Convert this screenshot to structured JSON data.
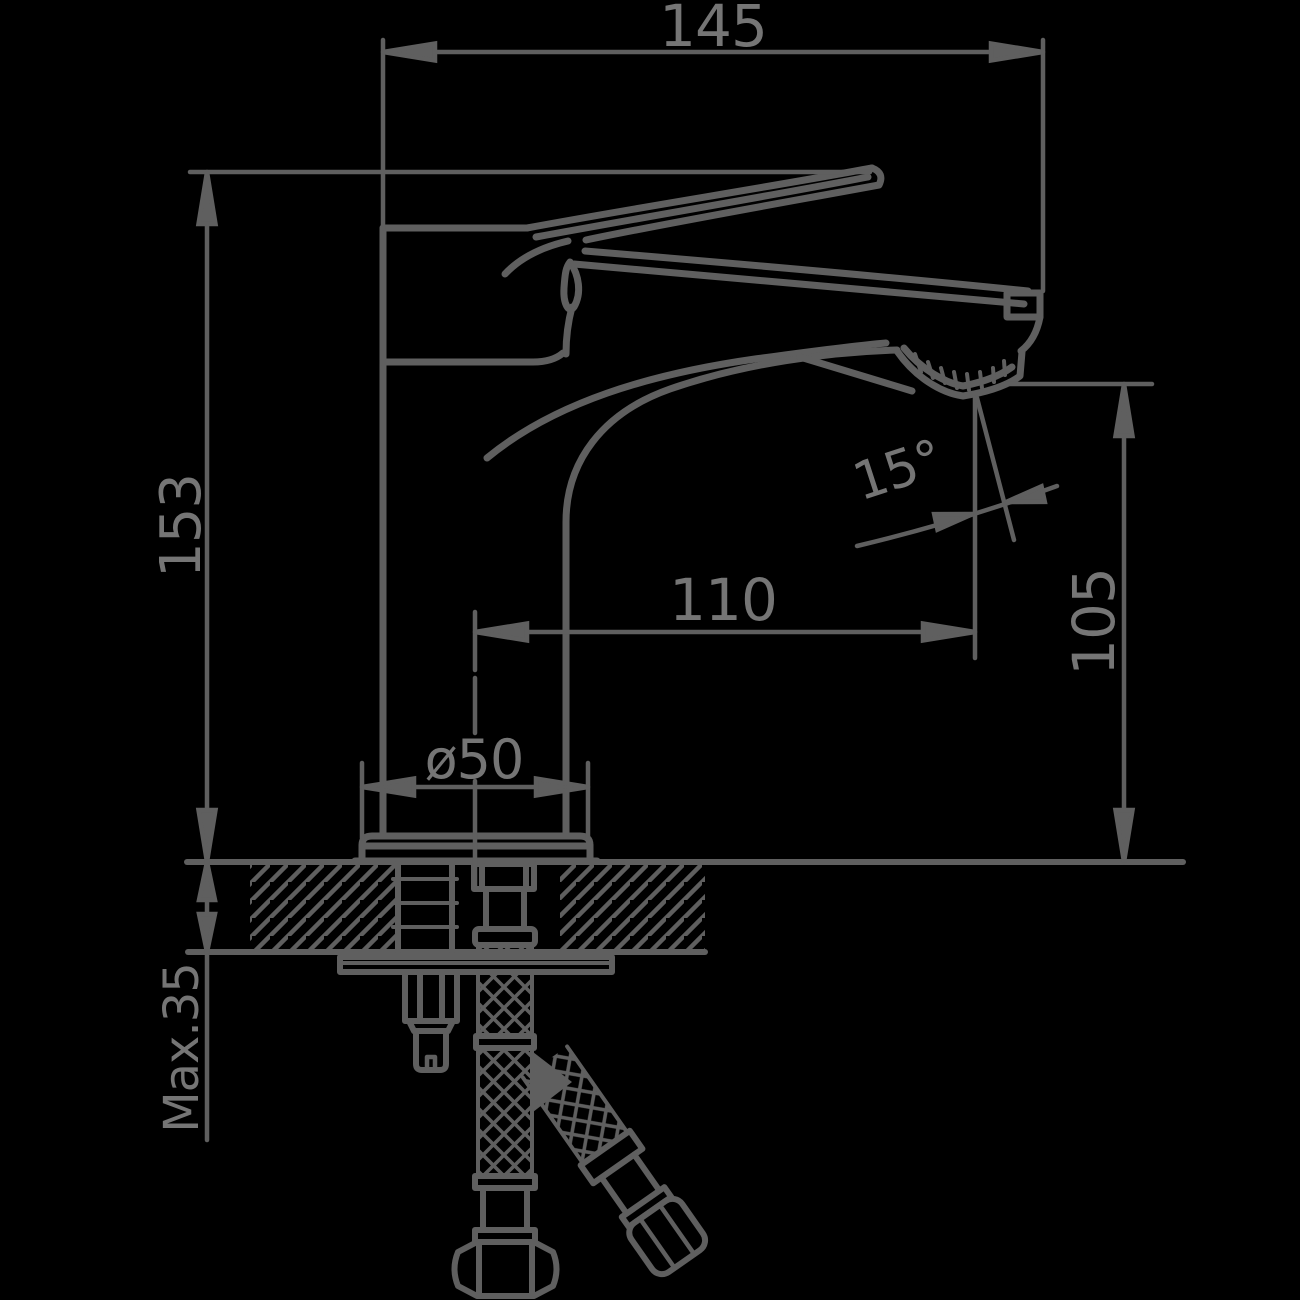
{
  "page": {
    "type": "technical dimension drawing",
    "subject": "single-lever basin mixer faucet, side elevation with deck mounting cross-section",
    "units": "mm"
  },
  "colors": {
    "background": "#000000",
    "line": "#5f5f5f",
    "text": "#757575"
  },
  "annotations": {
    "overall_width": "145",
    "overall_height": "153",
    "spout_reach": "110",
    "outlet_height": "105",
    "outlet_angle": "15°",
    "base_diameter": "ø50",
    "max_deck_thickness": "Max.35"
  }
}
